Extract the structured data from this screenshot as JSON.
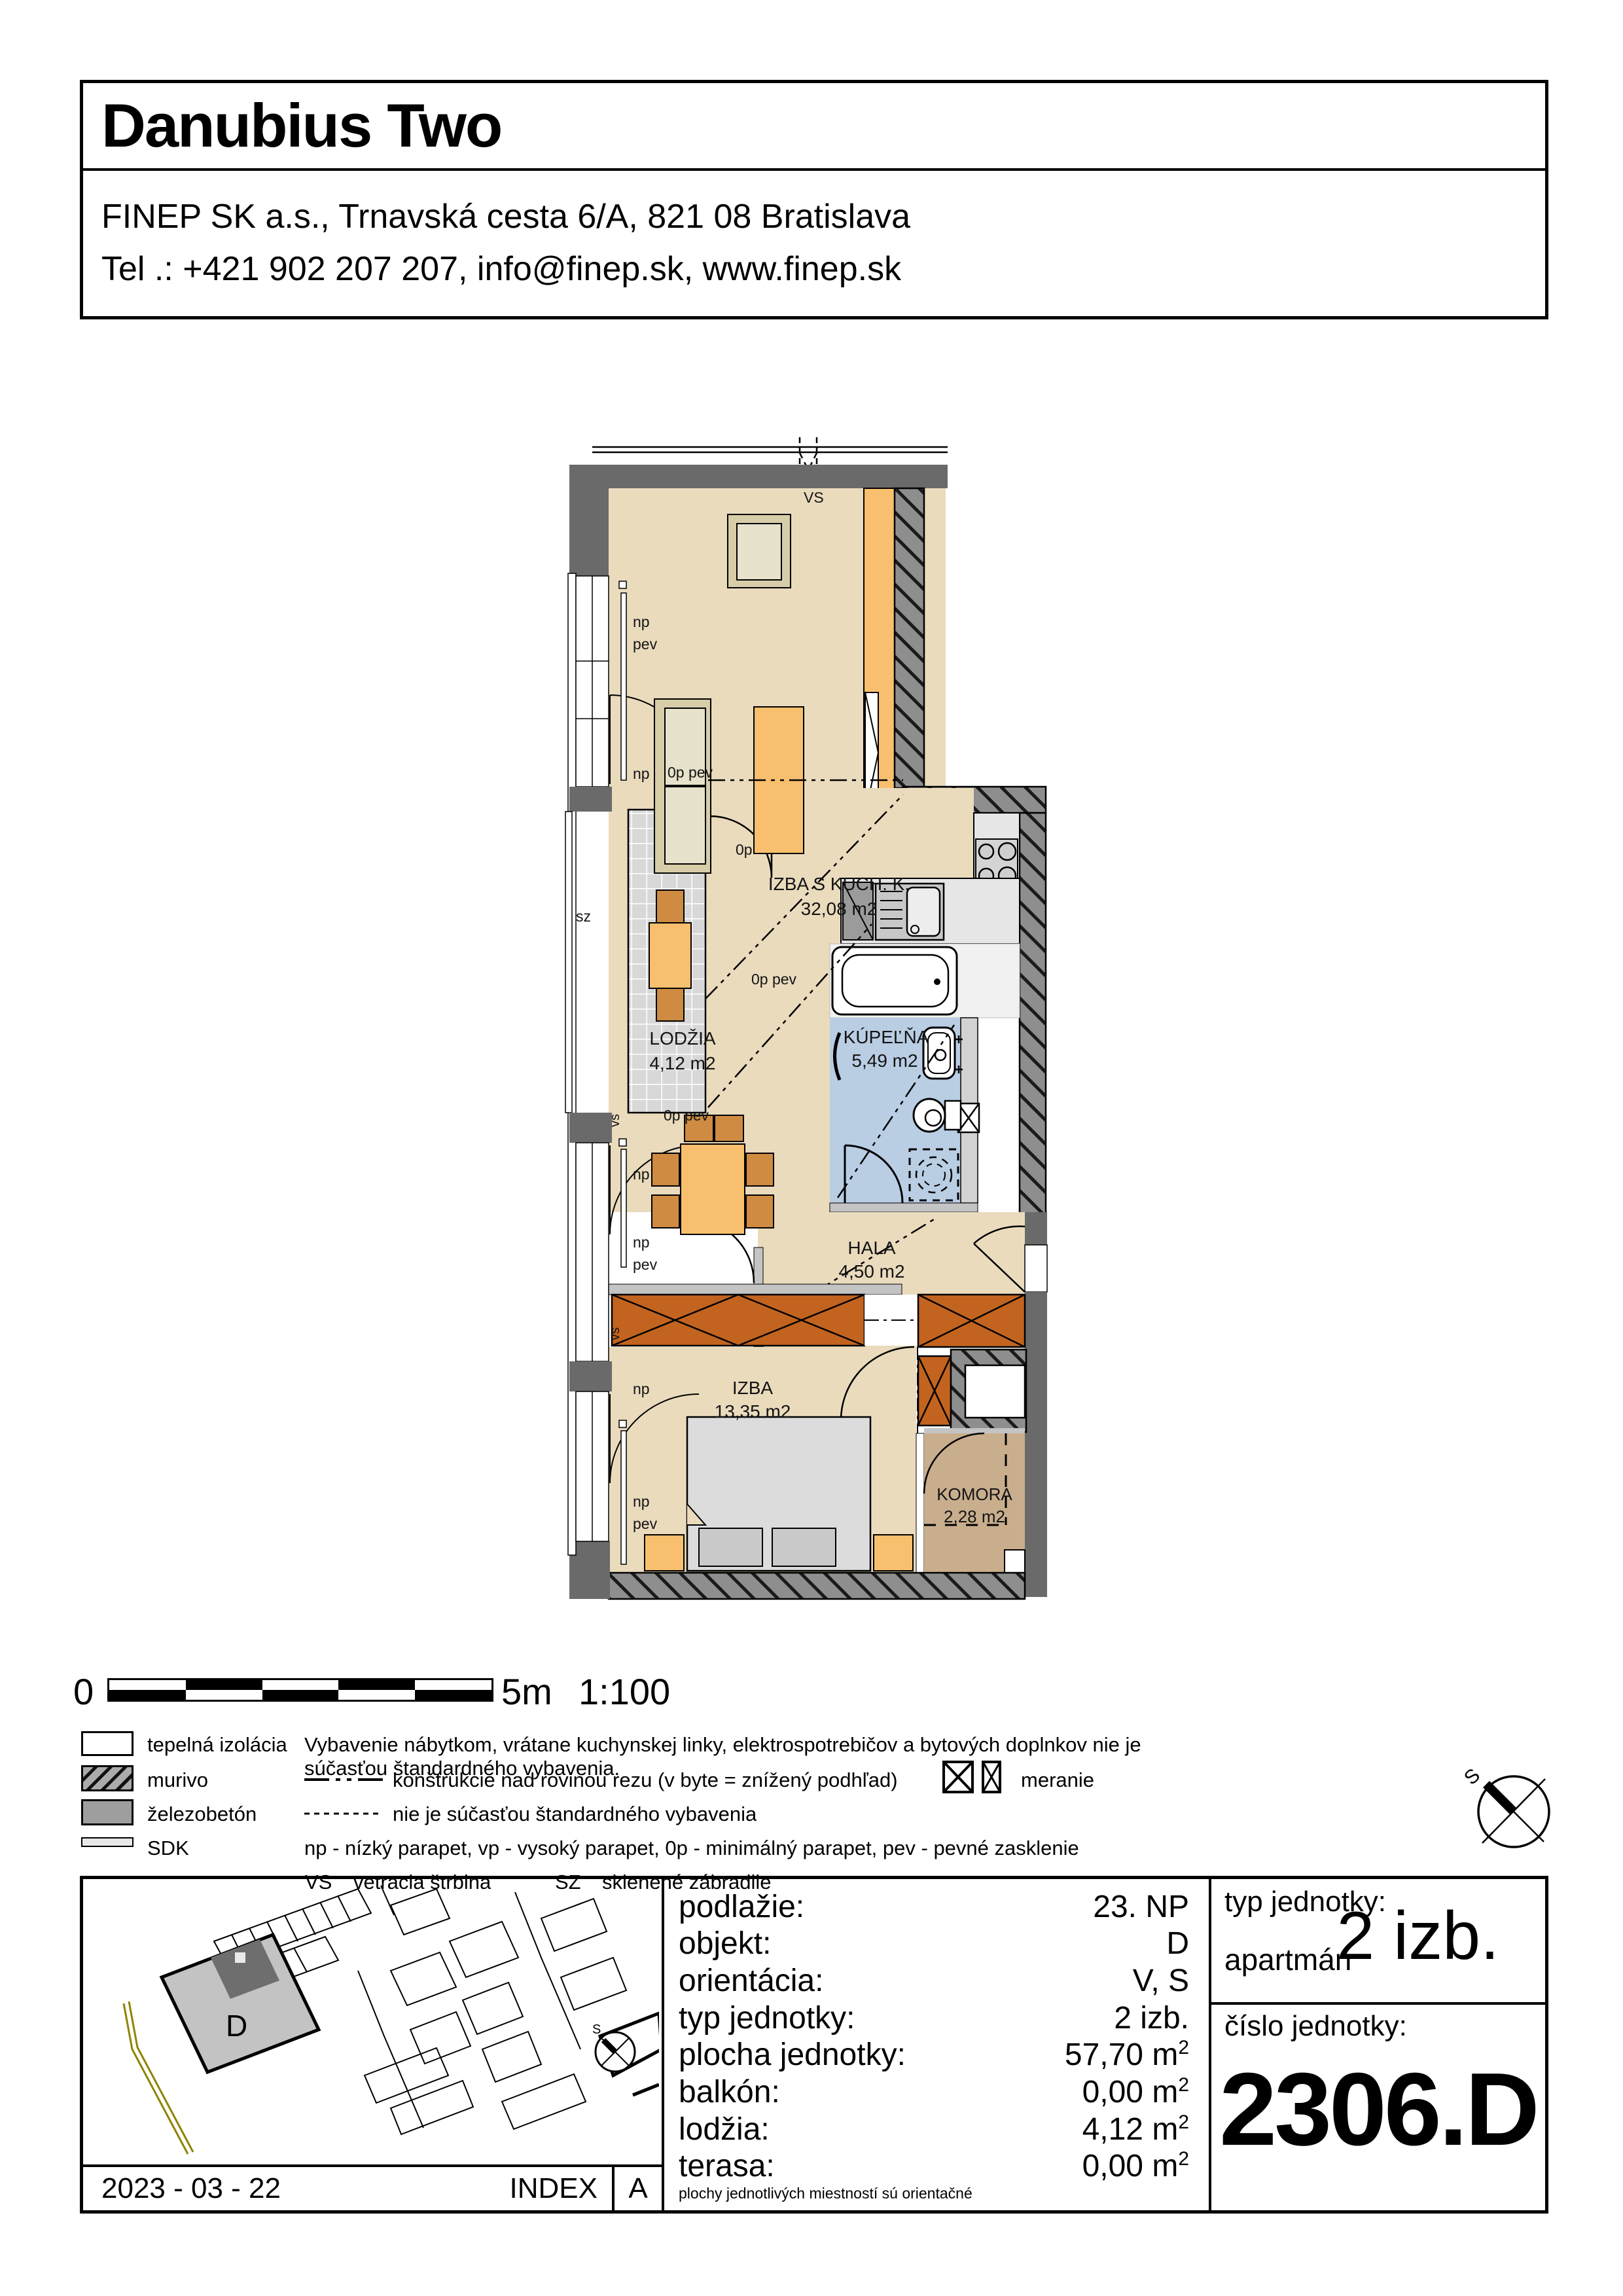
{
  "header": {
    "title": "Danubius Two",
    "address": "FINEP SK a.s., Trnavská cesta 6/A, 821 08 Bratislava",
    "contact": "Tel .: +421 902 207 207, info@finep.sk, www.finep.sk"
  },
  "plan": {
    "rooms": [
      {
        "name": "IZBA S KUCH. K.",
        "area": "32,08 m2"
      },
      {
        "name": "LODŽIA",
        "area": "4,12 m2"
      },
      {
        "name": "KÚPEĽŇA",
        "area": "5,49 m2"
      },
      {
        "name": "HALA",
        "area": "4,50 m2"
      },
      {
        "name": "IZBA",
        "area": "13,35 m2"
      },
      {
        "name": "KOMORA",
        "area": "2,28 m2"
      }
    ],
    "ann": {
      "vs_upper": "VS",
      "vs_lower": "vs",
      "sz": "sz",
      "np": "np",
      "pev": "pev",
      "op": "0p",
      "op_pev": "0p pev"
    }
  },
  "scalebar": {
    "zero": "0",
    "five": "5m",
    "ratio": "1:100"
  },
  "legend": {
    "materials": [
      {
        "label": "tepelná izolácia"
      },
      {
        "label": "murivo"
      },
      {
        "label": "železobetón"
      },
      {
        "label": "SDK"
      }
    ],
    "note_equipment": "Vybavenie nábytkom, vrátane kuchynskej linky, elektrospotrebičov a bytových doplnkov nie je súčasťou štandardného vybavenia.",
    "line_above_cut": "konštrukcie nad rovinou rezu (v byte = znížený podhľad)",
    "meranie": "meranie",
    "line_not_standard": "nie je súčasťou štandardného vybavenia",
    "parapet_note": "np - nízký parapet, vp - vysoký parapet, 0p - minimálný parapet, pev - pevné zasklenie",
    "vs": "VS",
    "vs_label": "vetracia štrbina",
    "sz": "SZ",
    "sz_label": "sklenené zábradlie"
  },
  "info": {
    "rows": [
      {
        "label": "podlažie:",
        "value": "23. NP",
        "sup": ""
      },
      {
        "label": "objekt:",
        "value": "D",
        "sup": ""
      },
      {
        "label": "orientácia:",
        "value": "V, S",
        "sup": ""
      },
      {
        "label": "typ jednotky:",
        "value": "2 izb.",
        "sup": ""
      },
      {
        "label": "plocha jednotky:",
        "value": "57,70 m",
        "sup": "2"
      },
      {
        "label": "balkón:",
        "value": "0,00 m",
        "sup": "2"
      },
      {
        "label": "lodžia:",
        "value": "4,12 m",
        "sup": "2"
      },
      {
        "label": "terasa:",
        "value": "0,00 m",
        "sup": "2"
      }
    ],
    "note": "plochy jednotlivých miestností sú orientačné",
    "unit_type_label": "typ jednotky:",
    "unit_type_name": "apartmán",
    "unit_type_value": "2 izb.",
    "unit_number_label": "číslo jednotky:",
    "unit_number": "2306.D",
    "date": "2023 - 03 - 22",
    "index_label": "INDEX",
    "index_value": "A",
    "map_building": "D",
    "compass": "S"
  },
  "colors": {
    "room_fill": "#EADBBD",
    "loggia_tile": "#D8D8D8",
    "bath_fill": "#B9CDE3",
    "komora_fill": "#C9AE8D",
    "furniture_orange": "#F8C06E",
    "chair_orange": "#CE8B41",
    "wardrobe_orange": "#C2641F",
    "wall_dark": "#6A6A6A",
    "counter_gray": "#E6E6E6"
  }
}
